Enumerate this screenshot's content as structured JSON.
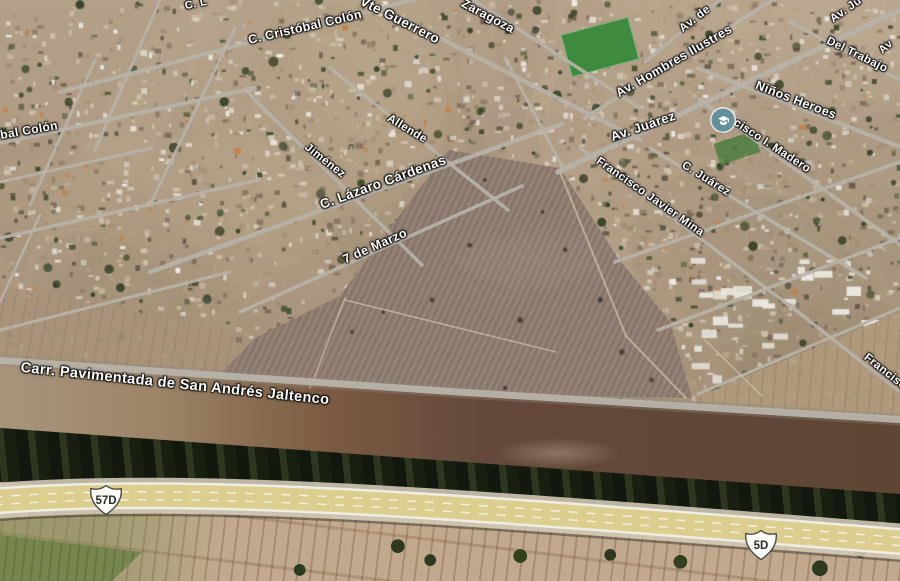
{
  "map": {
    "view": "satellite-3d-tilted",
    "street_labels": [
      {
        "text": "C. L",
        "x": 196,
        "y": 4,
        "rot": -12,
        "size": 11
      },
      {
        "text": "C. Cristóbal Colón",
        "x": 305,
        "y": 27,
        "rot": -13,
        "size": 12.5
      },
      {
        "text": "Vte Guerrero",
        "x": 400,
        "y": 20,
        "rot": 27,
        "size": 13.5
      },
      {
        "text": "Zaragoza",
        "x": 488,
        "y": 16,
        "rot": 28,
        "size": 12.5
      },
      {
        "text": "Av. de",
        "x": 695,
        "y": 19,
        "rot": -38,
        "size": 11.5
      },
      {
        "text": "Av. Ju",
        "x": 846,
        "y": 10,
        "rot": -35,
        "size": 11.5
      },
      {
        "text": "Av",
        "x": 886,
        "y": 47,
        "rot": -40,
        "size": 11
      },
      {
        "text": "Del Trabajo",
        "x": 857,
        "y": 55,
        "rot": 26,
        "size": 11.5
      },
      {
        "text": "Av. Hombres Ilustres",
        "x": 674,
        "y": 61,
        "rot": -30,
        "size": 12.5
      },
      {
        "text": "Niños Heroes",
        "x": 796,
        "y": 100,
        "rot": 21,
        "size": 12.5
      },
      {
        "text": "Av.  Juárez",
        "x": 643,
        "y": 126,
        "rot": -19,
        "size": 13
      },
      {
        "text": "cisco I. Madero",
        "x": 772,
        "y": 146,
        "rot": 33,
        "size": 11.5
      },
      {
        "text": "C.  Juárez",
        "x": 706,
        "y": 179,
        "rot": 32,
        "size": 11.5
      },
      {
        "text": "Francisco Javier Mina",
        "x": 650,
        "y": 197,
        "rot": 35,
        "size": 11.5
      },
      {
        "text": "Allende",
        "x": 407,
        "y": 129,
        "rot": 31,
        "size": 11.5
      },
      {
        "text": "Jiménez",
        "x": 325,
        "y": 161,
        "rot": 38,
        "size": 11.5
      },
      {
        "text": "C. Lázaro Cárdenas",
        "x": 383,
        "y": 182,
        "rot": -20,
        "size": 13.5
      },
      {
        "text": "7 de Marzo",
        "x": 375,
        "y": 246,
        "rot": -24,
        "size": 12.5
      },
      {
        "text": "bal Colón",
        "x": 29,
        "y": 130,
        "rot": -10,
        "size": 12
      },
      {
        "text": "Francisco",
        "x": 888,
        "y": 374,
        "rot": 38,
        "size": 11.5
      },
      {
        "text": "Carr. Pavimentada de San Andrés Jaltenco",
        "x": 175,
        "y": 384,
        "rot": 6,
        "size": 14.5
      }
    ],
    "route_shields": [
      {
        "text": "57D",
        "x": 106,
        "y": 500
      },
      {
        "text": "5D",
        "x": 761,
        "y": 545
      }
    ],
    "poi_school": {
      "icon": "graduation-cap-icon",
      "x": 723,
      "y": 120,
      "color": "#64909e"
    },
    "colors": {
      "highway_surface": "#dbce8e",
      "highway_edge": "#f0ede2",
      "street": "#b7b2a8",
      "open_field": "#8e7a6f",
      "canal_trees": "#222a18",
      "label_text": "#ffffff"
    }
  }
}
